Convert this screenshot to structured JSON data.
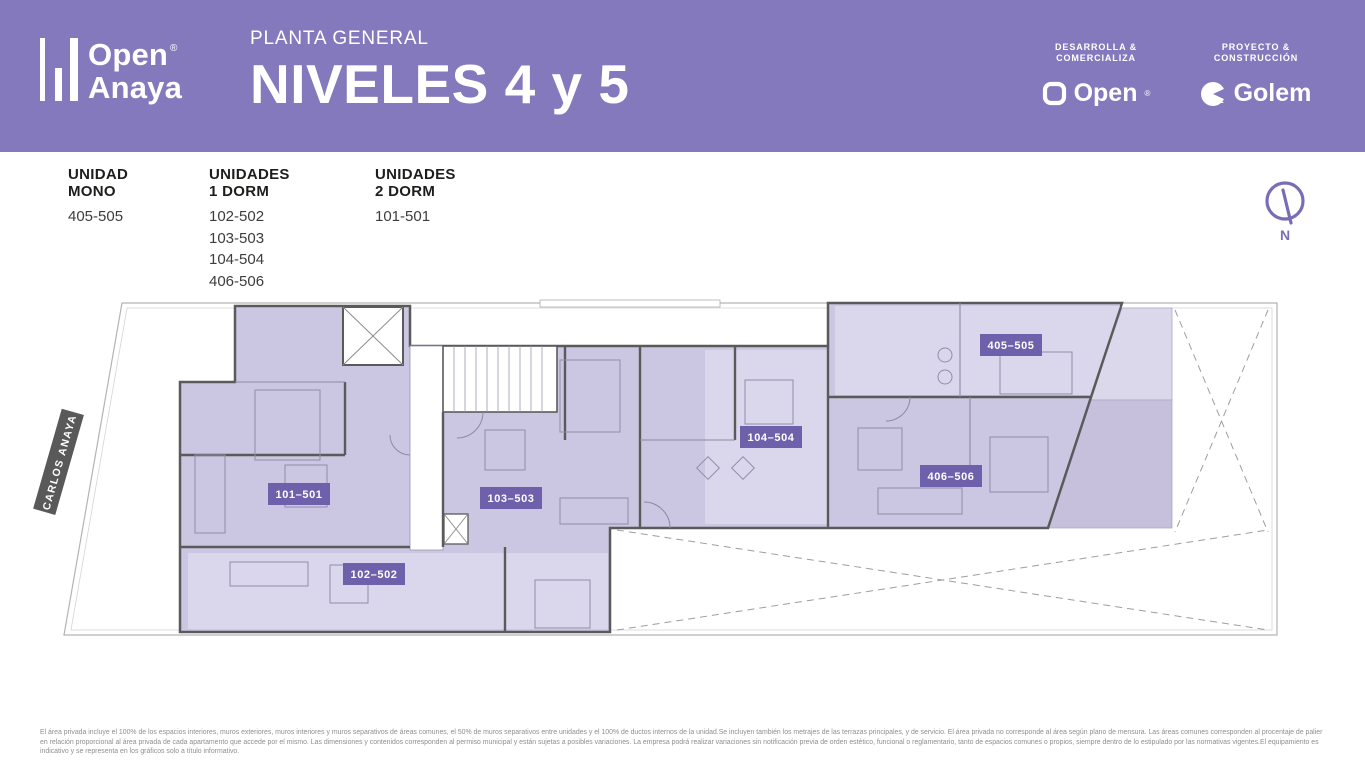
{
  "header": {
    "bg_color": "#8579bd",
    "logo": {
      "brand_top": "Open",
      "brand_bottom": "Anaya",
      "registered": "®"
    },
    "subtitle": "PLANTA GENERAL",
    "title": "NIVELES 4 y 5",
    "partners": [
      {
        "role_line1": "DESARROLLA &",
        "role_line2": "COMERCIALIZA",
        "brand": "Open",
        "registered": "®"
      },
      {
        "role_line1": "PROYECTO &",
        "role_line2": "CONSTRUCCIÓN",
        "brand": "Golem"
      }
    ]
  },
  "legend": {
    "columns": [
      {
        "heading": "UNIDAD MONO",
        "items": [
          "405-505"
        ]
      },
      {
        "heading": "UNIDADES 1 DORM",
        "items": [
          "102-502",
          "103-503",
          "104-504",
          "406-506"
        ]
      },
      {
        "heading": "UNIDADES 2 DORM",
        "items": [
          "101-501"
        ]
      }
    ]
  },
  "compass": {
    "label": "N",
    "color": "#7a6db8"
  },
  "plan": {
    "street_label": "CARLOS ANAYA",
    "units": [
      {
        "badge": "101–501"
      },
      {
        "badge": "102–502"
      },
      {
        "badge": "103–503"
      },
      {
        "badge": "104–504"
      },
      {
        "badge": "405–505"
      },
      {
        "badge": "406–506"
      }
    ],
    "colors": {
      "unit_fill": "#cbc6e1",
      "unit_fill_light": "#dad6eb",
      "terrace_fill": "#c6c0dc",
      "badge": "#6e60ab",
      "wall": "#5a5a5a",
      "street_box": "#595959"
    }
  },
  "footer": {
    "disclaimer": "El área privada incluye el 100% de los espacios interiores, muros exteriores, muros interiores y muros separativos de áreas comunes, el 50% de muros separativos entre unidades y el 100% de ductos internos de la unidad.Se incluyen también los metrajes de las terrazas principales, y de servicio. El área privada no corresponde al área según plano de mensura. Las áreas comunes corresponden al procentaje de palier en relación proporcional al área privada de cada apartamento que accede por el mismo. Las dimensiones y contenidos corresponden al permiso municipal y están sujetas a posibles variaciones. La empresa podrá realizar variaciones sin notificación previa de orden estético, funcional o reglamentario, tanto de espacios comunes o propios, siempre dentro de lo estipulado por las normativas vigentes.El equipamiento es indicativo y se representa en los gráficos solo a título informativo."
  }
}
